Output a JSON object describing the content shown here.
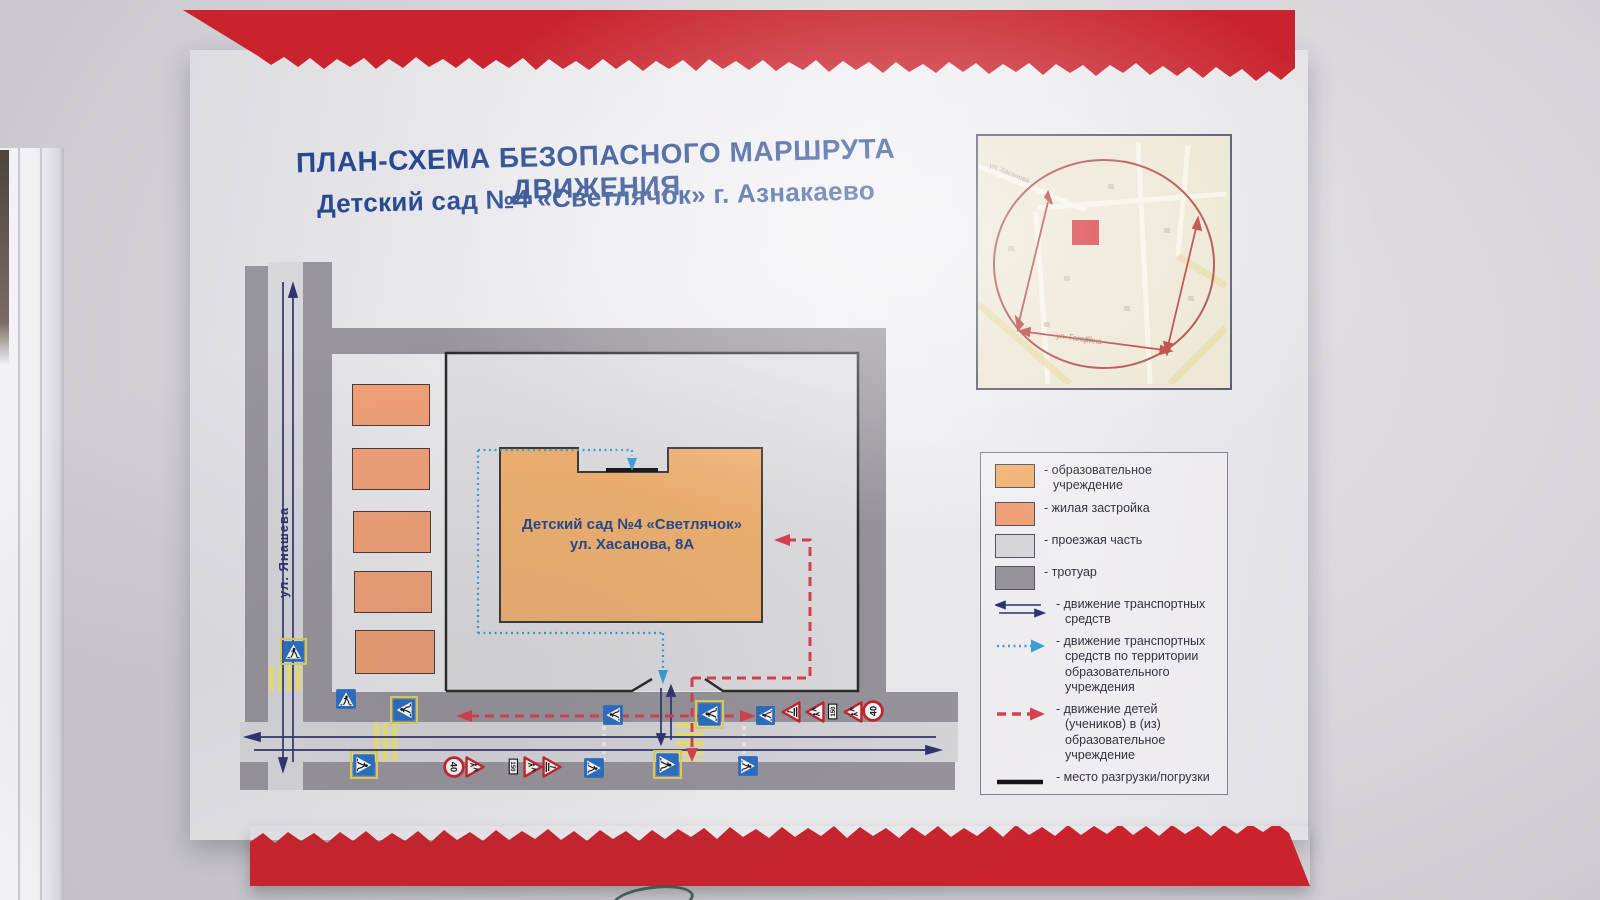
{
  "poster": {
    "title_line1": "ПЛАН-СХЕМА БЕЗОПАСНОГО МАРШРУТА ДВИЖЕНИЯ",
    "title_line2": "Детский сад №4 «Светлячок» г. Азнакаево"
  },
  "diagram": {
    "street_label": "ул. Янашева",
    "building_line1": "Детский сад №4 «Светлячок»",
    "building_line2": "ул. Хасанова, 8А",
    "sign_values": {
      "speed_limit": "40",
      "distance": "150"
    },
    "signs": [
      {
        "type": "crosswalk",
        "yellow": true,
        "x": 392,
        "y": 698,
        "size": 24,
        "rot": -90
      },
      {
        "type": "crosswalk",
        "x": 602,
        "y": 704,
        "size": 22,
        "rot": -90
      },
      {
        "type": "crosswalk",
        "yellow": true,
        "x": 697,
        "y": 702,
        "size": 25,
        "rot": -90
      },
      {
        "type": "crosswalk",
        "x": 755,
        "y": 705,
        "size": 21,
        "rot": -90
      },
      {
        "type": "warn",
        "x": 780,
        "y": 701,
        "size": 22,
        "rot": -90
      },
      {
        "type": "children",
        "x": 804,
        "y": 701,
        "size": 22,
        "rot": -90
      },
      {
        "type": "plate",
        "x": 824,
        "y": 703,
        "size": 17,
        "rot": -90
      },
      {
        "type": "children",
        "x": 842,
        "y": 701,
        "size": 22,
        "rot": -90
      },
      {
        "type": "limit",
        "x": 862,
        "y": 700,
        "size": 22,
        "rot": -90
      },
      {
        "type": "crosswalk",
        "yellow": true,
        "x": 352,
        "y": 753,
        "size": 24,
        "rot": 90
      },
      {
        "type": "limit",
        "x": 443,
        "y": 756,
        "size": 22,
        "rot": 90
      },
      {
        "type": "children",
        "x": 464,
        "y": 756,
        "size": 22,
        "rot": 90
      },
      {
        "type": "plate",
        "x": 505,
        "y": 758,
        "size": 17,
        "rot": 90
      },
      {
        "type": "children",
        "x": 522,
        "y": 756,
        "size": 22,
        "rot": 90
      },
      {
        "type": "warn",
        "x": 541,
        "y": 756,
        "size": 22,
        "rot": 90
      },
      {
        "type": "crosswalk",
        "x": 583,
        "y": 757,
        "size": 22,
        "rot": 90
      },
      {
        "type": "crosswalk",
        "yellow": true,
        "x": 655,
        "y": 752,
        "size": 25,
        "rot": 90
      },
      {
        "type": "crosswalk",
        "x": 737,
        "y": 755,
        "size": 22,
        "rot": 90
      },
      {
        "type": "crosswalk",
        "yellow": true,
        "x": 282,
        "y": 640,
        "size": 23,
        "rot": 0
      },
      {
        "type": "crosswalk",
        "x": 335,
        "y": 688,
        "size": 22,
        "rot": 0
      }
    ]
  },
  "inset": {
    "labels": [
      "ул. Гагарина",
      "ул. Хасанова"
    ]
  },
  "legend": {
    "items": [
      {
        "label": "- образовательное учреждение"
      },
      {
        "label": "- жилая застройка"
      },
      {
        "label": "- проезжая часть"
      },
      {
        "label": "- тротуар"
      },
      {
        "label": "- движение транспортных средств"
      },
      {
        "label": "- движение транспортных средств по территории образовательного учреждения"
      },
      {
        "label": "- движение детей (учеников) в (из) образовательное учреждение"
      },
      {
        "label": "- место разгрузки/погрузки"
      }
    ]
  },
  "colors": {
    "band_red": "#c9242d",
    "title_blue": "#27498f",
    "edu_building": "#f1b171",
    "residential": "#efa077",
    "roadway": "#d7d6da",
    "sidewalk": "#98949b",
    "territory": "#dedde1",
    "vehicle_arrow": "#2e3470",
    "territory_vehicle": "#3b9fd8",
    "children_route": "#d84150",
    "loading": "#151519",
    "crosswalk_yellow": "#ece37b",
    "sign_red": "#c5242c",
    "sign_blue": "#2a6fc4"
  }
}
